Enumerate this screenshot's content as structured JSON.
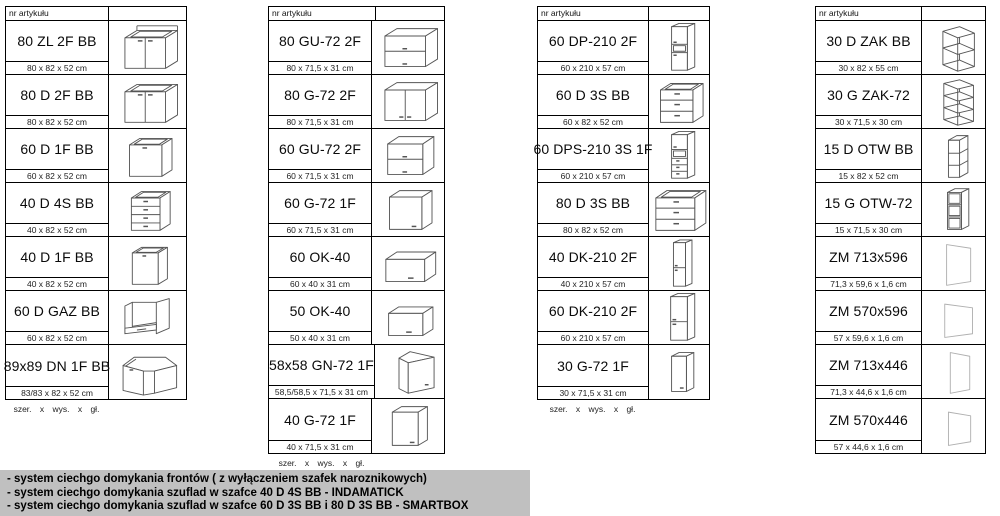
{
  "header_label": "nr artykułu",
  "size_legend": "szer.  x  wys.  x  gł.",
  "columns": [
    {
      "size_note": true,
      "items": [
        {
          "code": "80 ZL 2F BB",
          "dims": "80 x 82 x 52 cm",
          "icon": "base-sink-2door-icon"
        },
        {
          "code": "80 D 2F BB",
          "dims": "80 x 82 x 52 cm",
          "icon": "base-2door-icon"
        },
        {
          "code": "60 D 1F BB",
          "dims": "60 x 82 x 52 cm",
          "icon": "base-1door-icon"
        },
        {
          "code": "40 D 4S BB",
          "dims": "40 x 82 x 52 cm",
          "icon": "base-4drawer-icon"
        },
        {
          "code": "40 D 1F BB",
          "dims": "40 x 82 x 52 cm",
          "icon": "base-1door-narrow-icon"
        },
        {
          "code": "60 D GAZ BB",
          "dims": "60 x 82 x 52 cm",
          "icon": "base-oven-icon"
        },
        {
          "code": "89x89 DN 1F BB",
          "dims": "83/83 x 82 x 52 cm",
          "icon": "base-corner-icon"
        }
      ]
    },
    {
      "size_note": true,
      "items": [
        {
          "code": "80 GU-72 2F",
          "dims": "80 x 71,5 x 31 cm",
          "icon": "wall-2flip-icon"
        },
        {
          "code": "80 G-72 2F",
          "dims": "80 x 71,5 x 31 cm",
          "icon": "wall-2door-icon"
        },
        {
          "code": "60 GU-72 2F",
          "dims": "60 x 71,5 x 31 cm",
          "icon": "wall-2flip-small-icon"
        },
        {
          "code": "60 G-72 1F",
          "dims": "60 x 71,5 x 31 cm",
          "icon": "wall-1door-icon"
        },
        {
          "code": "60 OK-40",
          "dims": "60 x 40 x 31 cm",
          "icon": "wall-flip-icon"
        },
        {
          "code": "50 OK-40",
          "dims": "50 x 40 x 31 cm",
          "icon": "wall-flip-small-icon"
        },
        {
          "code": "58x58 GN-72 1F",
          "dims": "58,5/58,5 x 71,5 x 31 cm",
          "icon": "wall-corner-icon"
        },
        {
          "code": "40 G-72 1F",
          "dims": "40 x 71,5 x 31 cm",
          "icon": "wall-1door-narrow-icon"
        }
      ]
    },
    {
      "size_note": true,
      "items": [
        {
          "code": "60 DP-210 2F",
          "dims": "60 x 210 x 57 cm",
          "icon": "tall-2door-niche-icon"
        },
        {
          "code": "60 D 3S BB",
          "dims": "60 x 82 x 52 cm",
          "icon": "base-3drawer-icon"
        },
        {
          "code": "60 DPS-210 3S 1F",
          "dims": "60 x 210 x 57 cm",
          "icon": "tall-niche-drawers-icon"
        },
        {
          "code": "80 D 3S BB",
          "dims": "80 x 82 x 52 cm",
          "icon": "base-3drawer-wide-icon"
        },
        {
          "code": "40 DK-210 2F",
          "dims": "40 x 210 x 57 cm",
          "icon": "tall-2door-narrow-icon"
        },
        {
          "code": "60 DK-210 2F",
          "dims": "60 x 210 x 57 cm",
          "icon": "tall-2door-icon"
        },
        {
          "code": "30 G-72 1F",
          "dims": "30 x 71,5 x 31 cm",
          "icon": "wall-1door-slim-icon"
        }
      ]
    },
    {
      "size_note": false,
      "items": [
        {
          "code": "30 D ZAK BB",
          "dims": "30 x 82 x 55 cm",
          "icon": "corner-shelf-base-icon"
        },
        {
          "code": "30 G ZAK-72",
          "dims": "30 x 71,5 x 30 cm",
          "icon": "corner-shelf-wall-icon"
        },
        {
          "code": "15 D OTW BB",
          "dims": "15 x 82 x 52 cm",
          "icon": "open-shelf-base-icon"
        },
        {
          "code": "15 G OTW-72",
          "dims": "15 x 71,5 x 30 cm",
          "icon": "open-shelf-wall-icon"
        },
        {
          "code": "ZM 713x596",
          "dims": "71,3 x 59,6 x 1,6 cm",
          "icon": "panel-tall-icon"
        },
        {
          "code": "ZM 570x596",
          "dims": "57 x 59,6 x 1,6 cm",
          "icon": "panel-short-icon"
        },
        {
          "code": "ZM 713x446",
          "dims": "71,3 x 44,6 x 1,6 cm",
          "icon": "panel-tall-narrow-icon"
        },
        {
          "code": "ZM 570x446",
          "dims": "57 x 44,6 x 1,6 cm",
          "icon": "panel-short-narrow-icon"
        }
      ]
    }
  ],
  "legend_lines": [
    "- system ciechgo domykania frontów ( z wyłączeniem szafek naroznikowych)",
    "- system ciechgo domykania szuflad w szafce 40 D 4S BB - INDAMATICK",
    "- system ciechgo domykania szuflad w szafce 60 D 3S BB i 80 D 3S BB - SMARTBOX"
  ],
  "colors": {
    "legend_bg": "#c0c0c0",
    "table_border": "#000000",
    "diagram_stroke": "#555555",
    "panel_stroke": "#b0b0b0"
  }
}
